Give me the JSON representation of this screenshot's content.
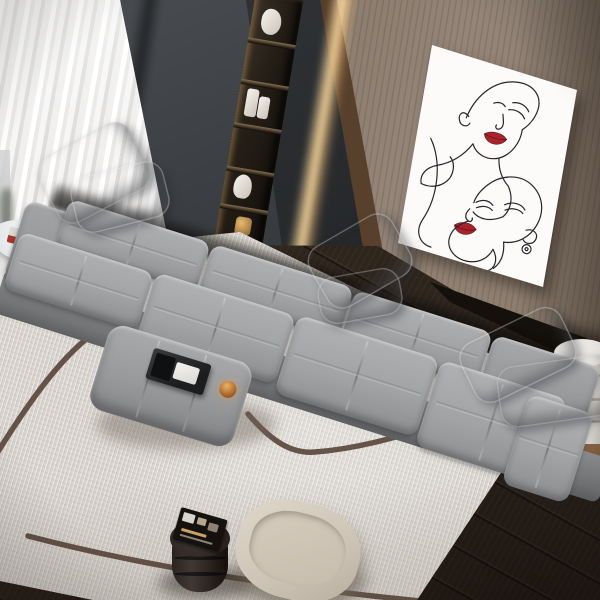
{
  "meta": {
    "title": "Modern living room, elevated top view — grey modular sofa, cream rug with arc motif, one-line face art print",
    "type": "interior-photograph"
  },
  "colors": {
    "wall-dark": "#35383c",
    "wall-wood": "#8e8075",
    "curtain": "#f1f0ee",
    "led-glow": "#ffdb9e",
    "trim-wood": "#5a4331",
    "cabinet": "#26282a",
    "poster": "#fcfbfa",
    "ink-line": "#26262a",
    "lips-red": "#a8232c",
    "sofa-grey": "#a5a6a8",
    "sofa-deep": "#7d7e81",
    "rug-cream": "#dad6cf",
    "rug-line": "#4a342a",
    "floor-walnut": "#2e251d",
    "ottoman-grey": "#9c9d9f",
    "tray-black": "#1c1d1f",
    "candle-amber": "#c08347",
    "stool-brown": "#2c2421",
    "pouf-cream": "#d7cec1",
    "table-white": "#edebe7",
    "table-wood-base": "#8a6647"
  },
  "objects": {
    "curtain": {
      "label": "Sheer white pleated curtains"
    },
    "dark_wall": {
      "label": "Charcoal feature wall"
    },
    "shelf_unit": {
      "label": "Recessed display shelving with warm accent lighting",
      "items": [
        "white sculpture",
        "white candle pair",
        "white ornament",
        "gold decor piece"
      ]
    },
    "led_strip": {
      "label": "Warm LED strip along wood trim"
    },
    "wood_wall": {
      "label": "Wood panelled wall"
    },
    "poster": {
      "label": "One-line art print of two female faces with red lips"
    },
    "sofa": {
      "label": "Long grey modular fabric sofa with tufted cushions",
      "modules": 5,
      "pillows": 6
    },
    "ottoman": {
      "label": "Grey upholstered ottoman coffee table",
      "tray": "black tray with white napkins",
      "candle": "amber glass candle holder"
    },
    "rug": {
      "label": "Cream textured rug with dark curved line motif"
    },
    "side_table": {
      "label": "White round side table with pedestal base",
      "items": [
        "magazine",
        "small white figurine"
      ]
    },
    "stool": {
      "label": "Dark drum stool with magazine on top"
    },
    "pouf": {
      "label": "Cream rounded pouf"
    },
    "cylinder_table": {
      "label": "White cylindrical side table on round wood base"
    },
    "floor": {
      "label": "Dark walnut plank flooring"
    },
    "light_floor": {
      "label": "Light floor strip by the window"
    }
  }
}
